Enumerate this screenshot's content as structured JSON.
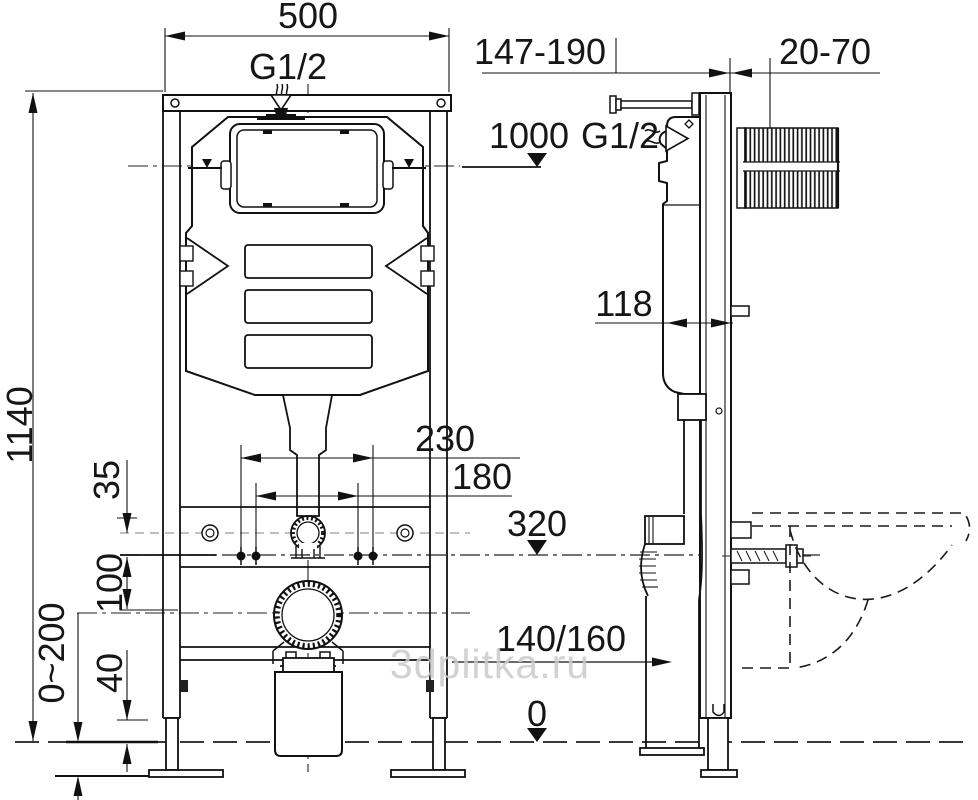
{
  "watermark": "3dplitka.ru",
  "front_view": {
    "dim_width": "500",
    "inlet_label": "G1/2",
    "dim_height": "1140",
    "dim_stud_outer": "230",
    "dim_stud_inner": "180",
    "dim_35": "35",
    "dim_100": "100",
    "dim_40": "40",
    "dim_floor_adjust": "0~200"
  },
  "side_view": {
    "dim_depth_range": "147-190",
    "dim_wall_range": "20-70",
    "dim_level_1000": "1000",
    "inlet_label": "G1/2",
    "dim_depth": "118",
    "dim_level_320": "320",
    "dim_drain_height": "140/160",
    "dim_level_0": "0"
  }
}
